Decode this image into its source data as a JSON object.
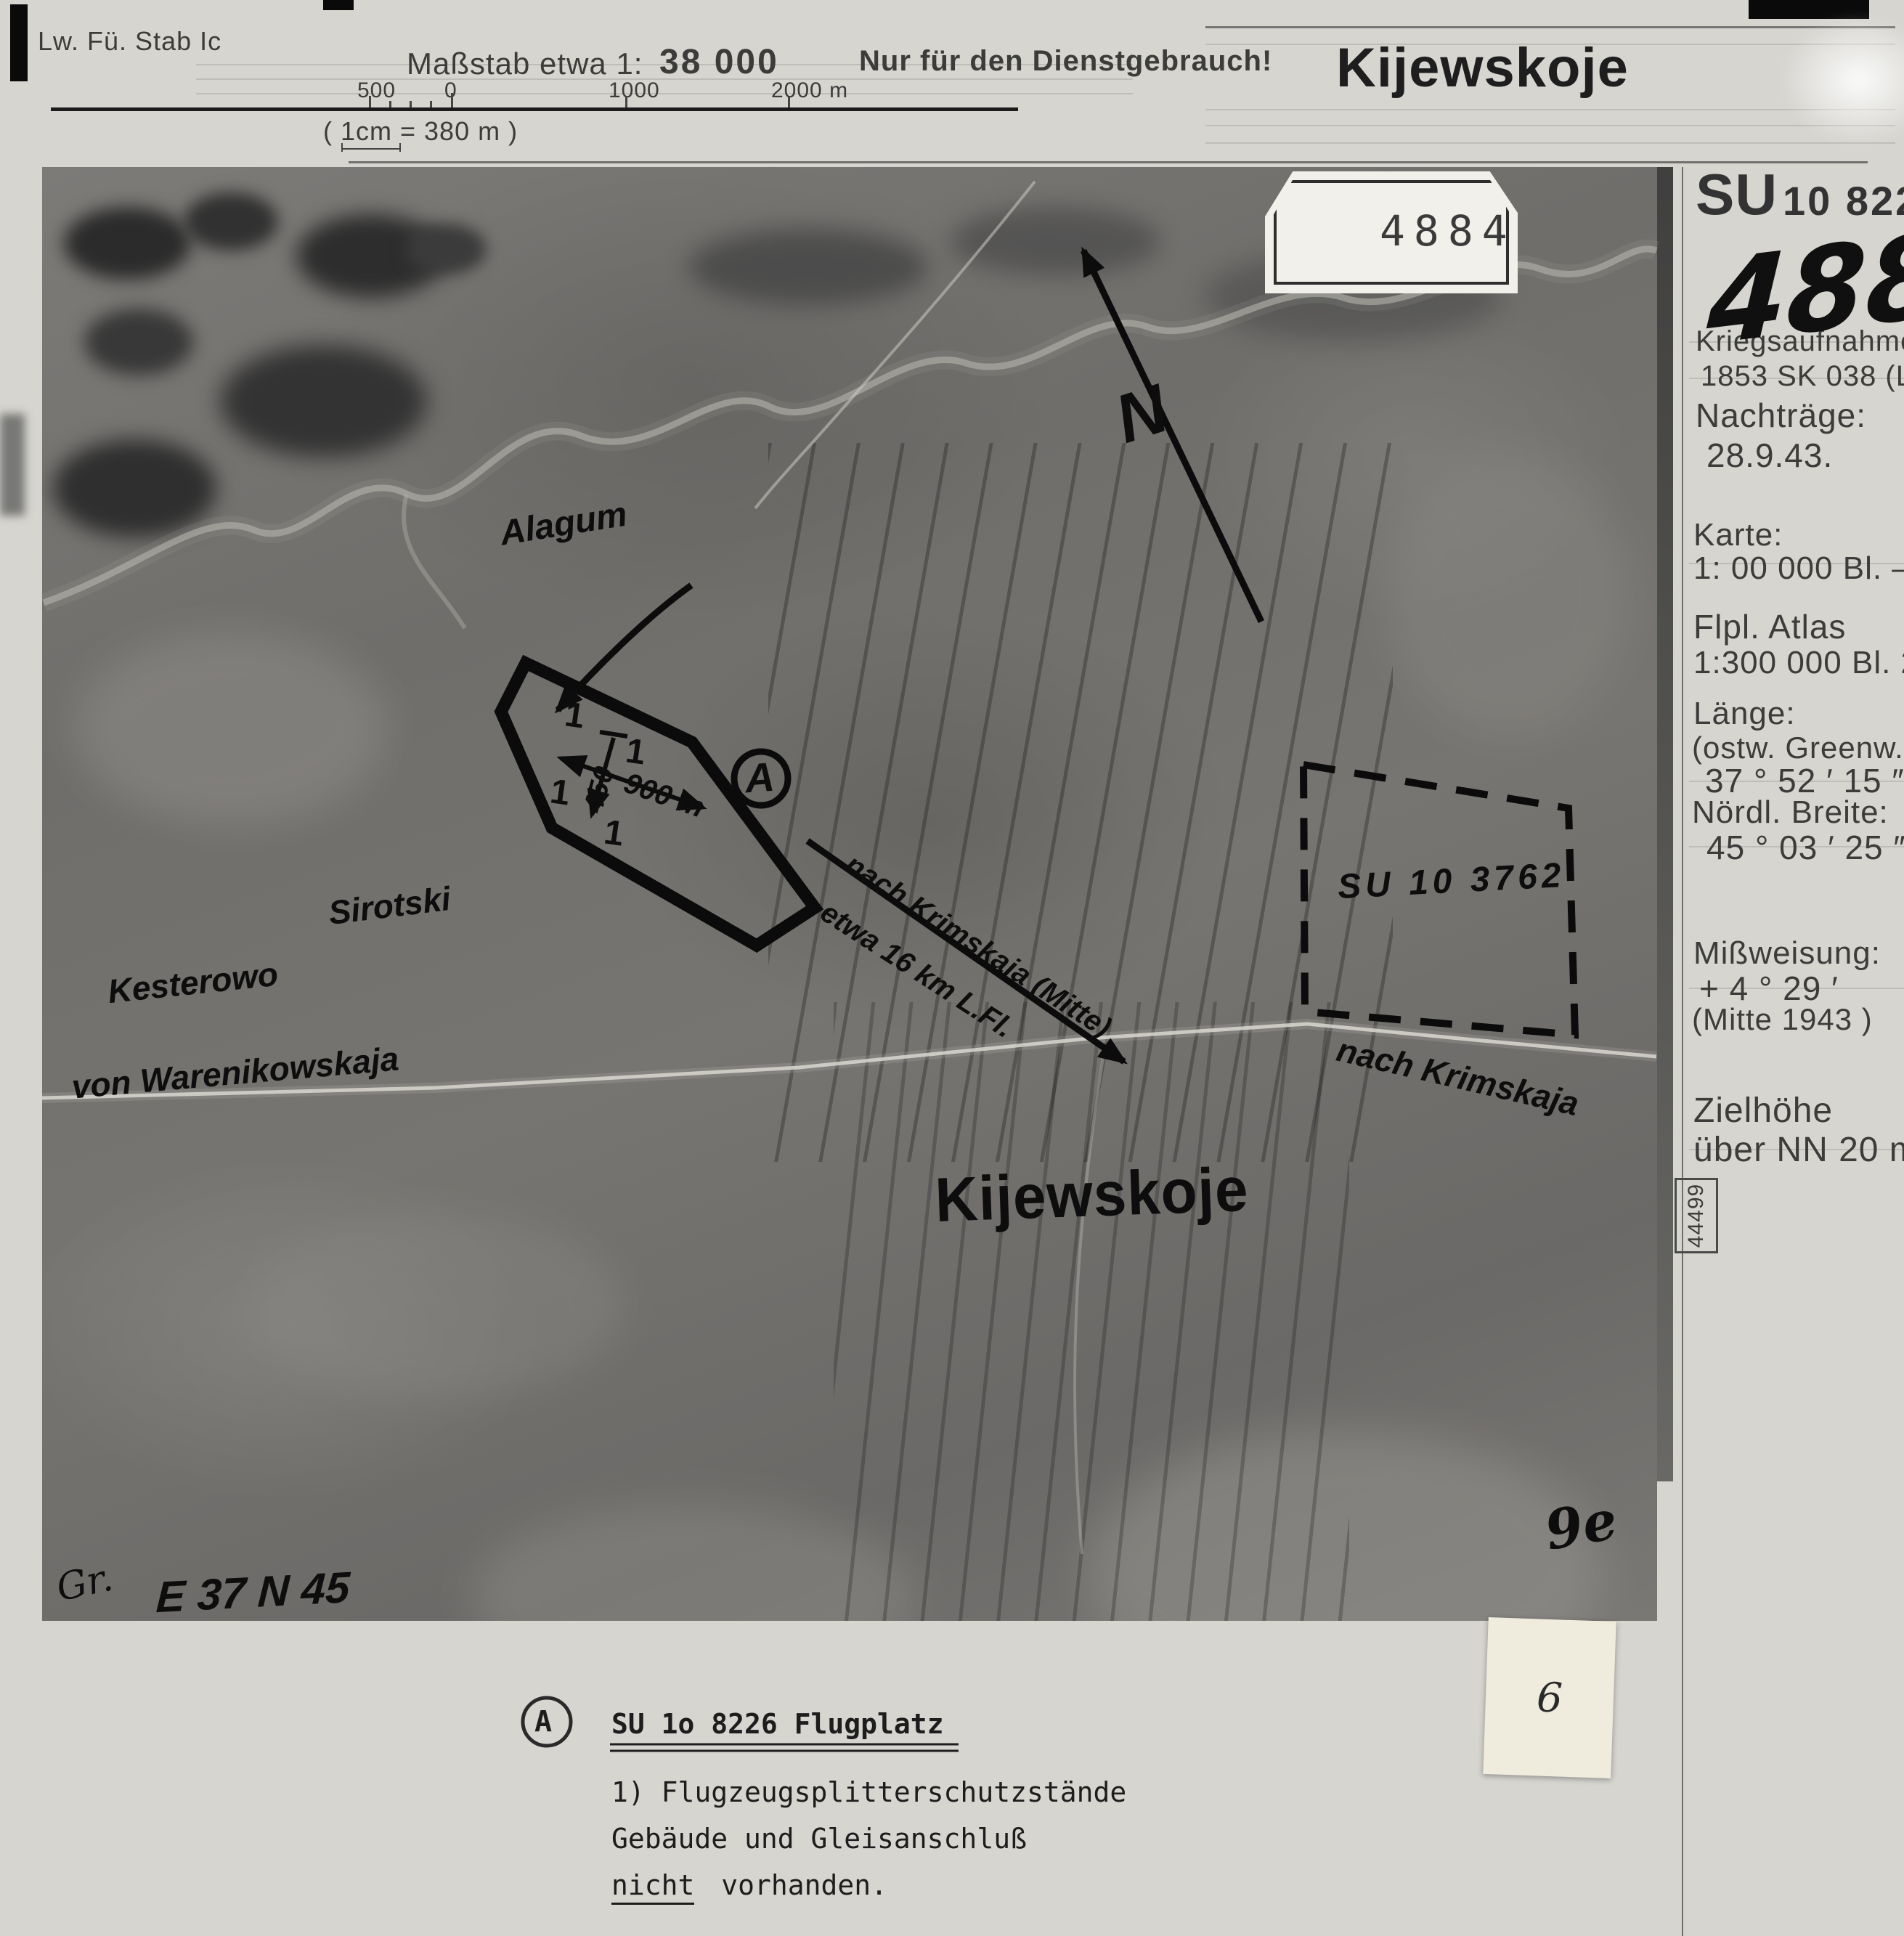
{
  "header": {
    "unit": "Lw. Fü. Stab Ic",
    "scale_prefix": "Maßstab etwa 1:",
    "scale_value": "38 000",
    "tick_500": "500",
    "tick_0": "0",
    "tick_1000": "1000",
    "tick_2000": "2000 m",
    "cm_note": "( 1cm = 380 m )",
    "restricted": "Nur für den Dienstgebrauch!",
    "title": "Kijewskoje"
  },
  "photo": {
    "tag_number": "4884",
    "north_letter": "N",
    "labels": {
      "river": "Alagum",
      "sirotski": "Sirotski",
      "kesterowo": "Kesterowo",
      "road_from": "von Warenikowskaja",
      "route_1": "nach Krimskaja (Mitte)",
      "route_2": "etwa 16 km L.Fl.",
      "neighbor_target": "SU 10 3762",
      "road_to": "nach Krimskaja",
      "town": "Kijewskoje",
      "marker": "A",
      "dim_long": "900 m",
      "dim_short": "450",
      "mark_1a": "1",
      "mark_1b": "1",
      "mark_1c": "1",
      "mark_1d": "1",
      "grid_ref": "E 37 N 45",
      "initials": "Gr.",
      "check_mark": "9e"
    }
  },
  "sidebar": {
    "target_prefix": "SU",
    "target_number": "10 8226",
    "photo_number": "4884",
    "capture_label": "Kriegsaufnahme",
    "capture_ref": "1853 SK 038 (LflA",
    "addenda_label": "Nachträge:",
    "addenda_date": "28.9.43.",
    "map_label": "Karte:",
    "map_value": "1:  00 000 Bl.  —",
    "atlas_label": "Flpl. Atlas",
    "atlas_value": "1:300 000 Bl. 244",
    "longitude_label": "Länge:",
    "longitude_sub": "(ostw. Greenw.):",
    "longitude_value": "37 ° 52 ′ 15 ″",
    "latitude_label": "Nördl. Breite:",
    "latitude_value": "45 ° 03 ′ 25 ″",
    "declination_label": "Mißweisung:",
    "declination_value": "+ 4 ° 29 ′",
    "declination_note": "(Mitte 1943 )",
    "height_label": "Zielhöhe",
    "height_value": "über NN 20   m",
    "file_number": "44499"
  },
  "legend": {
    "marker": "A",
    "title": "SU  1o 8226 Flugplatz",
    "line1": "1) Flugzeugsplitterschutzstände",
    "line2": "Gebäude und Gleisanschluß",
    "line3_underlined": "nicht",
    "line3_rest": "vorhanden.",
    "slip_number": "6"
  }
}
